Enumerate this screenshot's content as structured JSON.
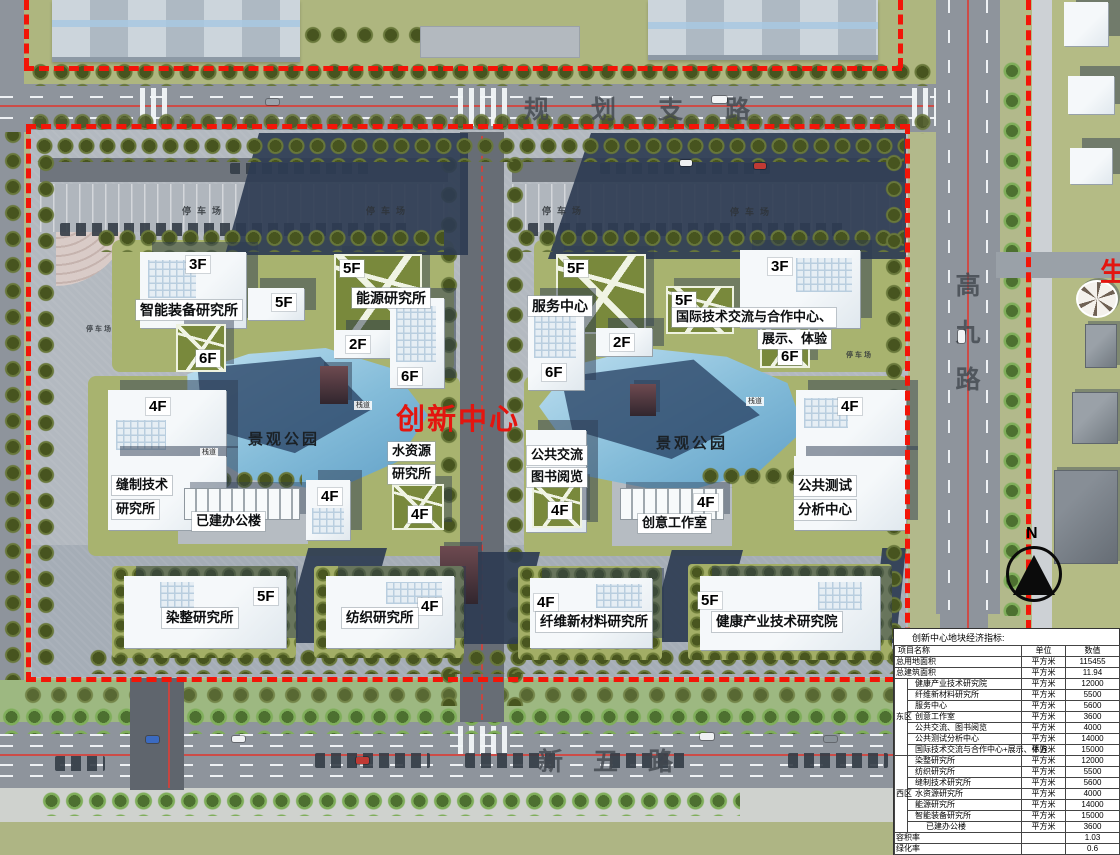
{
  "colors": {
    "boundary_red": "#f21508",
    "center_red": "#e4150f",
    "shadow_navy": "#2e3c52",
    "water_blue": "#84bcd9",
    "lawn_olive": "#a8b36f"
  },
  "map": {
    "center_label": "创新中心",
    "roads": {
      "top": "规划支路",
      "right": "高九路",
      "bottom": "新五路"
    },
    "park": "景观公园",
    "parking": "停车场",
    "boardwalk": "栈道",
    "north": "N",
    "offsite": "生",
    "floors": {
      "f2": "2F",
      "f3": "3F",
      "f4": "4F",
      "f5": "5F",
      "f6": "6F"
    },
    "west": {
      "smart": "智能装备研究所",
      "energy": "能源研究所",
      "sewing1": "缝制技术",
      "sewing2": "研究所",
      "office": "已建办公楼",
      "water1": "水资源",
      "water2": "研究所",
      "dyeing": "染整研究所",
      "textile": "纺织研究所"
    },
    "east": {
      "service": "服务中心",
      "intl1": "国际技术交流与合作中心、",
      "intl2": "展示、体验",
      "exchange1": "公共交流",
      "exchange2": "图书阅览",
      "creative": "创意工作室",
      "testing1": "公共测试",
      "testing2": "分析中心",
      "fiber": "纤维新材料研究所",
      "health": "健康产业技术研究院"
    }
  },
  "table": {
    "title": "创新中心地块经济指标:",
    "headers": [
      "项目名称",
      "单位",
      "数值"
    ],
    "rows": [
      {
        "name": "总用地面积",
        "unit": "平方米",
        "value": "115455"
      },
      {
        "name": "总建筑面积",
        "unit": "平方米",
        "value": "11.94"
      },
      {
        "group": "东区",
        "name": "健康产业技术研究院",
        "unit": "平方米",
        "value": "12000"
      },
      {
        "group": "东区",
        "name": "纤维新材料研究所",
        "unit": "平方米",
        "value": "5500"
      },
      {
        "group": "东区",
        "name": "服务中心",
        "unit": "平方米",
        "value": "5600"
      },
      {
        "group": "东区",
        "name": "创意工作室",
        "unit": "平方米",
        "value": "3600"
      },
      {
        "group": "东区",
        "name": "公共交流、图书阅览",
        "unit": "平方米",
        "value": "4000"
      },
      {
        "group": "东区",
        "name": "公共测试分析中心",
        "unit": "平方米",
        "value": "14000"
      },
      {
        "group": "东区",
        "name": "国际技术交流与合作中心+展示、体验",
        "unit": "平方米",
        "value": "15000"
      },
      {
        "group": "西区",
        "name": "染整研究所",
        "unit": "平方米",
        "value": "12000"
      },
      {
        "group": "西区",
        "name": "纺织研究所",
        "unit": "平方米",
        "value": "5500"
      },
      {
        "group": "西区",
        "name": "缝制技术研究所",
        "unit": "平方米",
        "value": "5600"
      },
      {
        "group": "西区",
        "name": "水资源研究所",
        "unit": "平方米",
        "value": "4000"
      },
      {
        "group": "西区",
        "name": "能源研究所",
        "unit": "平方米",
        "value": "14000"
      },
      {
        "group": "西区",
        "name": "智能装备研究所",
        "unit": "平方米",
        "value": "15000"
      },
      {
        "group": "西区",
        "name": "已建办公楼",
        "unit": "平方米",
        "value": "3600",
        "indent": 2
      },
      {
        "name": "容积率",
        "unit": "",
        "value": "1.03"
      },
      {
        "name": "绿化率",
        "unit": "",
        "value": "0.6"
      }
    ]
  }
}
